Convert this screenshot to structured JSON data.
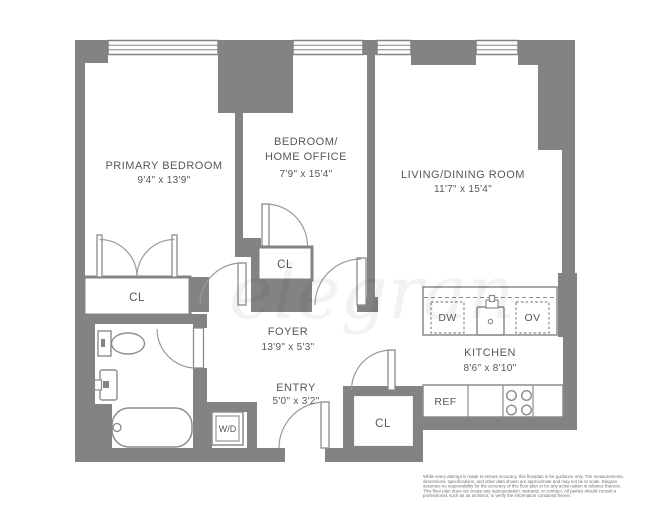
{
  "colors": {
    "wall": "#838383",
    "fixture_stroke": "#8b8b8b",
    "door_arc": "#9a9a9a",
    "label_text": "#575757",
    "disclaimer_text": "#6f6f6f",
    "watermark_fill": "rgba(0,0,0,0.05)",
    "floor": "#ffffff"
  },
  "rooms": {
    "primary_bedroom": {
      "name": "PRIMARY BEDROOM",
      "dims": "9'4\" x 13'9\""
    },
    "home_office": {
      "name_line1": "BEDROOM/",
      "name_line2": "HOME OFFICE",
      "dims": "7'9\" x 15'4\""
    },
    "living_dining": {
      "name": "LIVING/DINING ROOM",
      "dims": "11'7\" x 15'4\""
    },
    "foyer": {
      "name": "FOYER",
      "dims": "13'9\" x 5'3\""
    },
    "entry": {
      "name": "ENTRY",
      "dims": "5'0\" x 3'2\""
    },
    "kitchen": {
      "name": "KITCHEN",
      "dims": "8'6\" x 8'10\""
    }
  },
  "closets": {
    "primary_closet": "CL",
    "office_closet": "CL",
    "entry_closet": "CL"
  },
  "appliances": {
    "washer_dryer": "W/D",
    "dishwasher": "DW",
    "oven": "OV",
    "refrigerator": "REF"
  },
  "watermark": "elegran",
  "disclaimer": {
    "lines": [
      "While every attempt is made to ensure accuracy, this floorplan is for guidance only. The measurements,",
      "dimensions, specifications, and other data shown are approximate and may not be to scale. Elegran",
      "assumes no responsibility for the accuracy of this floor plan or for any action taken in reliance thereon.",
      "This floor plan does not create any representation, warranty, or contract. All parties should consult a",
      "professional, such as an architect, to verify the information contained herein."
    ]
  }
}
